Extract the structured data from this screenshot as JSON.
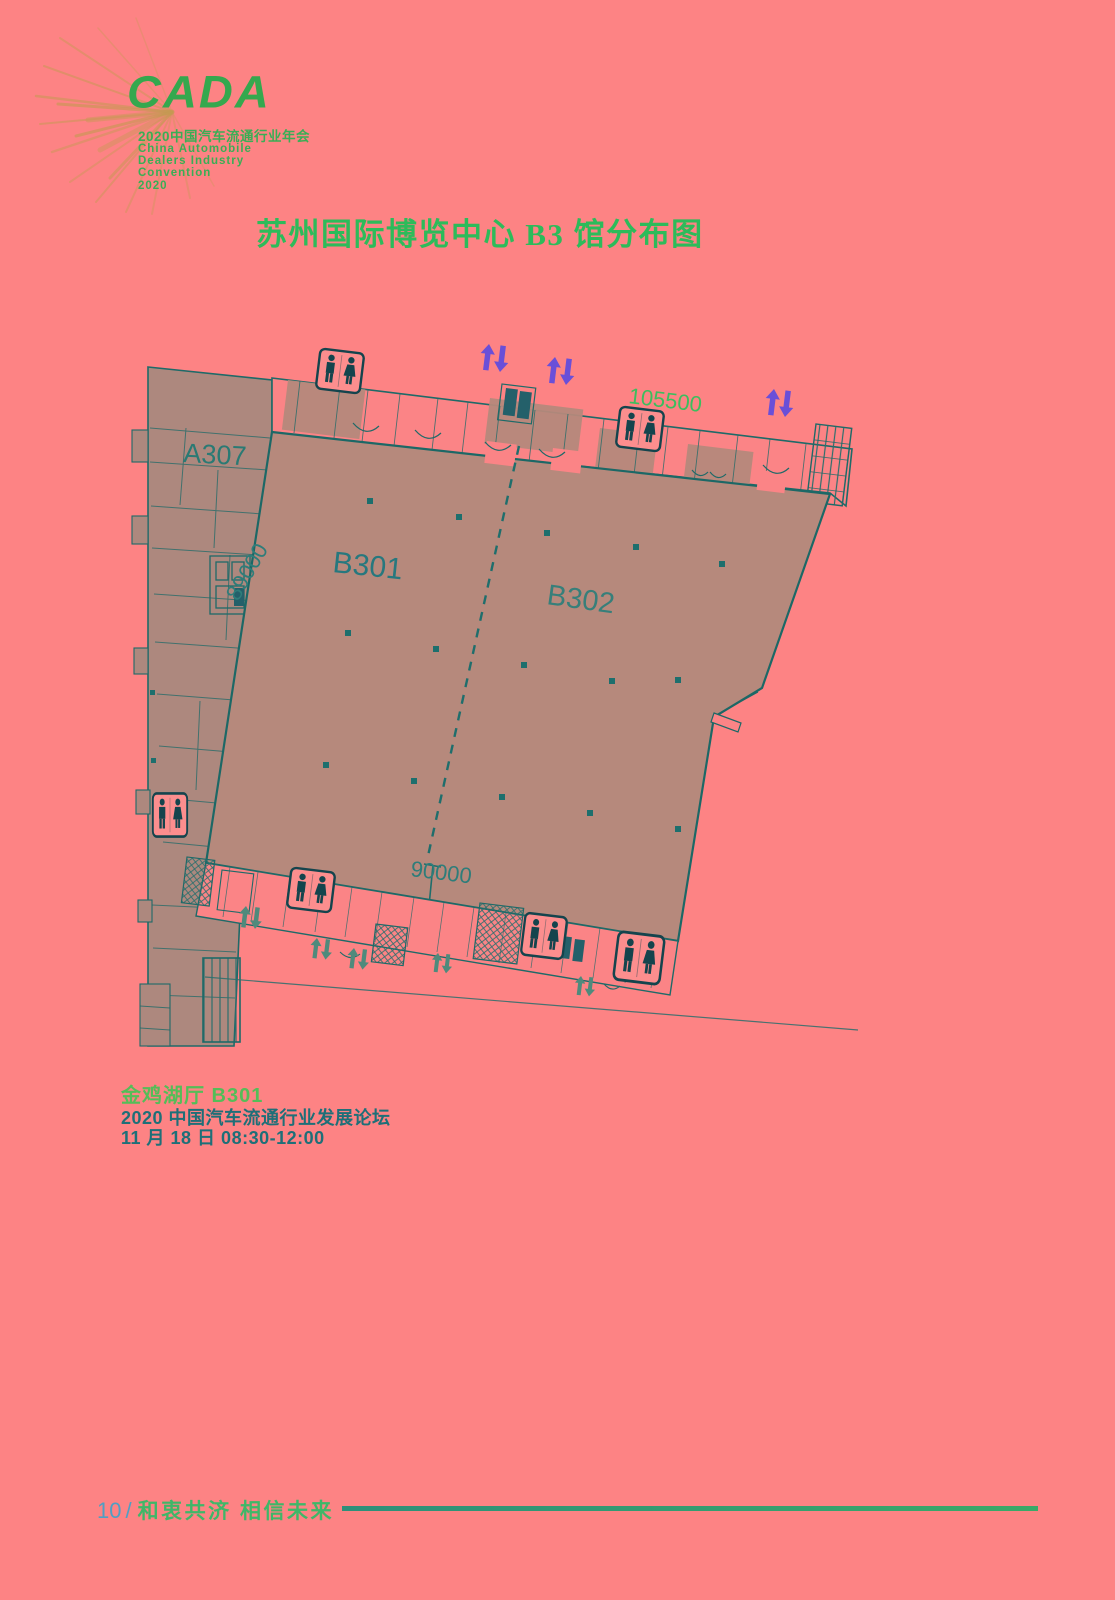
{
  "page": {
    "background": "#fd8384"
  },
  "colors": {
    "brand_green": "#3aae55",
    "title_green": "#2dbb5a",
    "plan_line_teal": "#1e6a68",
    "hall_fill": "#b6897c",
    "wing_fill": "#ad887e",
    "dim_green": "#3cbe5e",
    "dim_teal": "#2e7d7a",
    "escalator_purple": "#6a4fd8",
    "entrance_arrow_teal": "#4f8a7c",
    "page_number_blue": "#4f9fc4",
    "footer_green": "#3fb768"
  },
  "logo": {
    "brand": "CADA",
    "tagline": "2020中国汽车流通行业年会",
    "en_lines": [
      "China Automobile",
      "Dealers Industry",
      "Convention",
      "2020"
    ]
  },
  "title": {
    "text": "苏州国际博览中心 B3 馆分布图"
  },
  "floorplan": {
    "hall_b301": "B301",
    "hall_b302": "B302",
    "room_a307": "A307",
    "dim_top": "105500",
    "dim_left": "89000",
    "dim_bottom": "90000"
  },
  "session_info": {
    "venue": "金鸡湖厅 B301",
    "event": "2020 中国汽车流通行业发展论坛",
    "schedule": "11 月 18 日 08:30-12:00"
  },
  "footer": {
    "page_number": "10",
    "separator": "/",
    "slogan": "和衷共济 相信未来"
  }
}
